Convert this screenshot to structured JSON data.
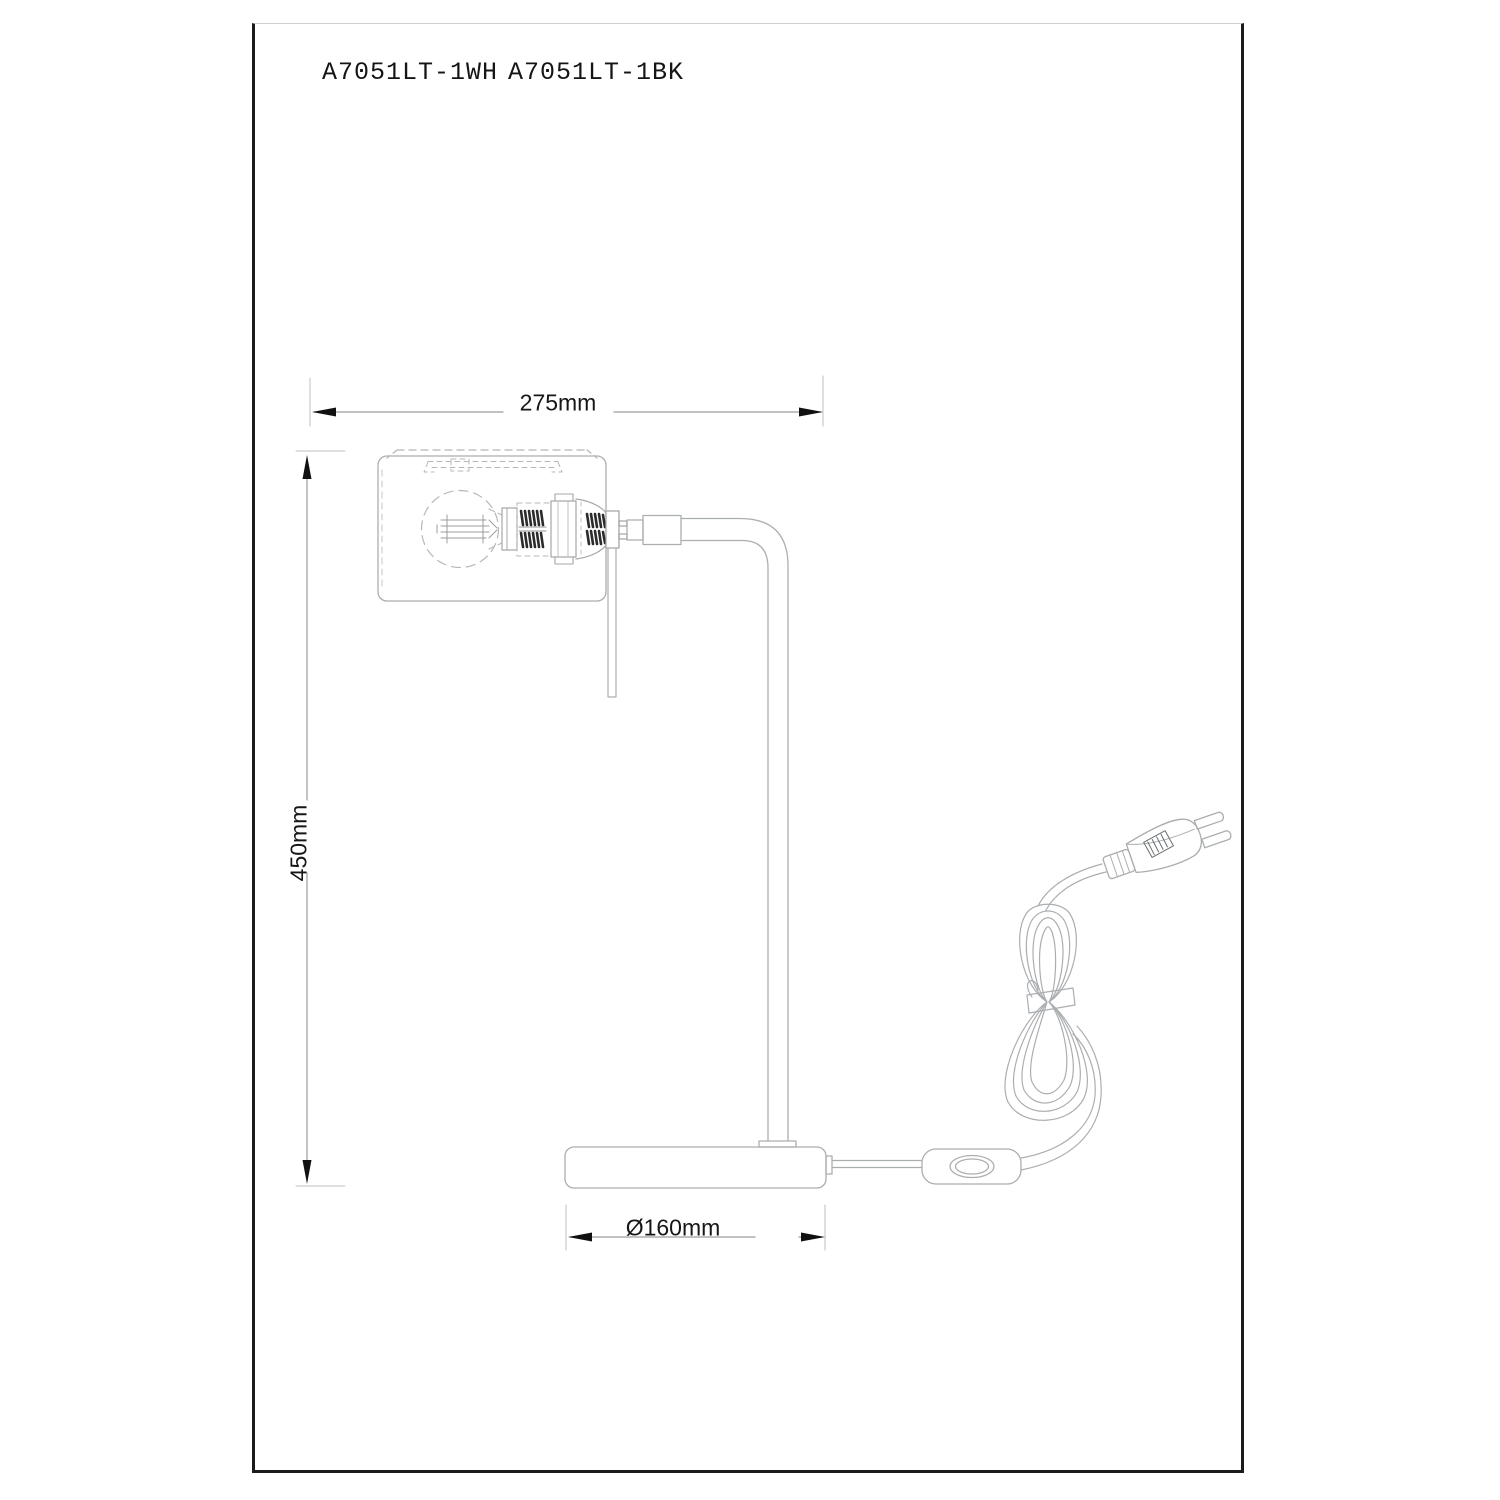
{
  "sheet": {
    "background": "#ffffff",
    "frame_color": "#1b1b1b",
    "frame_top_color": "#cfcfcf"
  },
  "title_block": {
    "model_white": "A7051LT-1WH",
    "model_black": "A7051LT-1BK"
  },
  "dimensions": {
    "width": {
      "label": "275mm"
    },
    "height": {
      "label": "450mm"
    },
    "base_diameter": {
      "label": "Ø160mm"
    }
  },
  "drawing": {
    "line_color": "#abaeb1",
    "dashed_line_color": "#b5b8ba",
    "dark_detail_color": "#2b2b2b",
    "dimension_line_color": "#9c9c9c",
    "extension_line_color": "#bfbfbf",
    "arrow_color": "#111111",
    "text_color": "#161616"
  }
}
